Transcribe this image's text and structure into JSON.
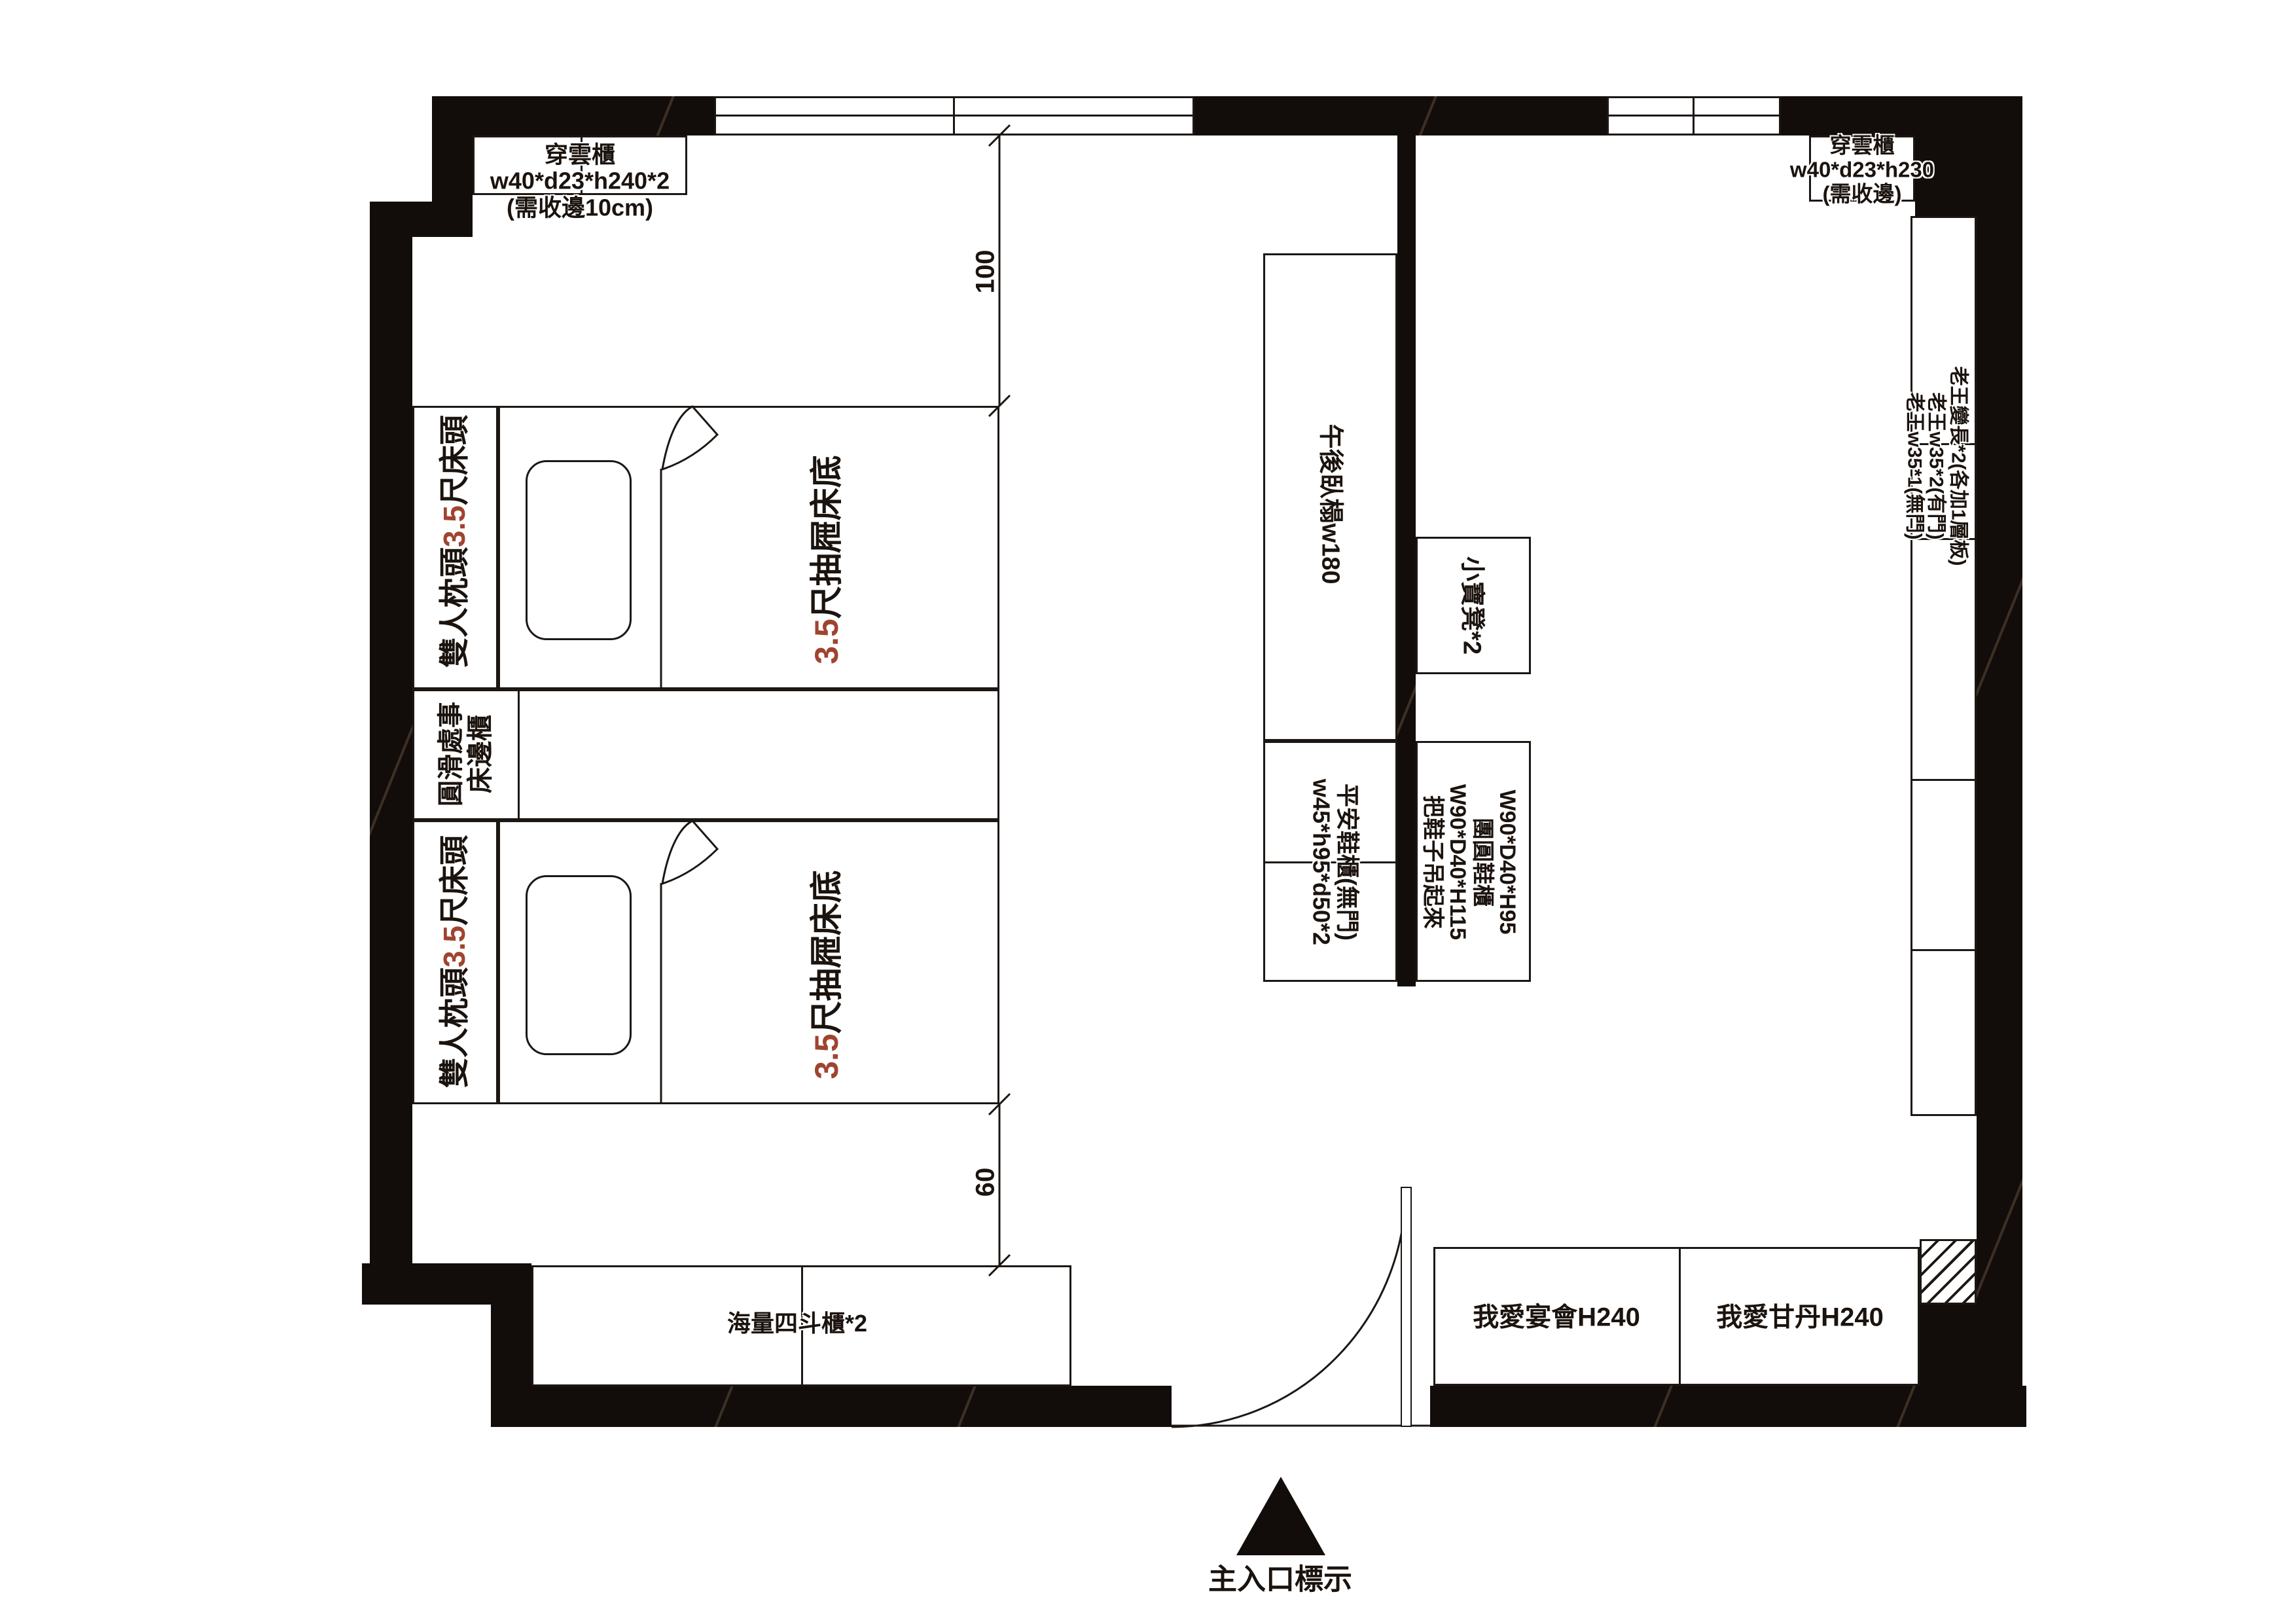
{
  "document": {
    "type": "furniture floor plan"
  },
  "colors": {
    "accent_red": "#a0442f",
    "wall": "#120d0a",
    "line": "#1c1713"
  },
  "dimensions": {
    "top": "100",
    "bottom": "60"
  },
  "closets": {
    "top_left": {
      "name": "穿雲櫃",
      "size": "w40*d23*h240*2",
      "note": "(需收邊10cm)"
    },
    "top_right": {
      "name": "穿雲櫃",
      "size": "w40*d23*h230",
      "note": "(需收邊)"
    }
  },
  "beds": {
    "headboard": {
      "prefix": "雙人枕頭",
      "highlight": "3.5",
      "suffix": "尺床頭"
    },
    "base": {
      "highlight": "3.5",
      "suffix": "尺抽屜床底"
    }
  },
  "nightstand": {
    "columns": [
      "圓滑處事",
      "床邊櫃"
    ]
  },
  "daybed": {
    "label": "午後臥榻w180"
  },
  "stool": {
    "label": "小寶凳*2"
  },
  "shoe_cabinet_left": {
    "columns": [
      "w45*h95*d50*2",
      "平安鞋櫃(無門)"
    ]
  },
  "shoe_cabinet_right": {
    "columns": [
      "把鞋子吊起來",
      "W90*D40*H115",
      "團圓鞋櫃",
      "W90*D40*H95"
    ]
  },
  "tall_cabinets": {
    "columns": [
      "老王w35*1(無門)",
      "老王w35*2(有門)",
      "老王變長*2(各加1層板)"
    ]
  },
  "dresser": {
    "label": "海量四斗櫃*2"
  },
  "wardrobe": {
    "left": "我愛宴會H240",
    "right": "我愛甘丹H240"
  },
  "entrance": {
    "label": "主入口標示"
  }
}
